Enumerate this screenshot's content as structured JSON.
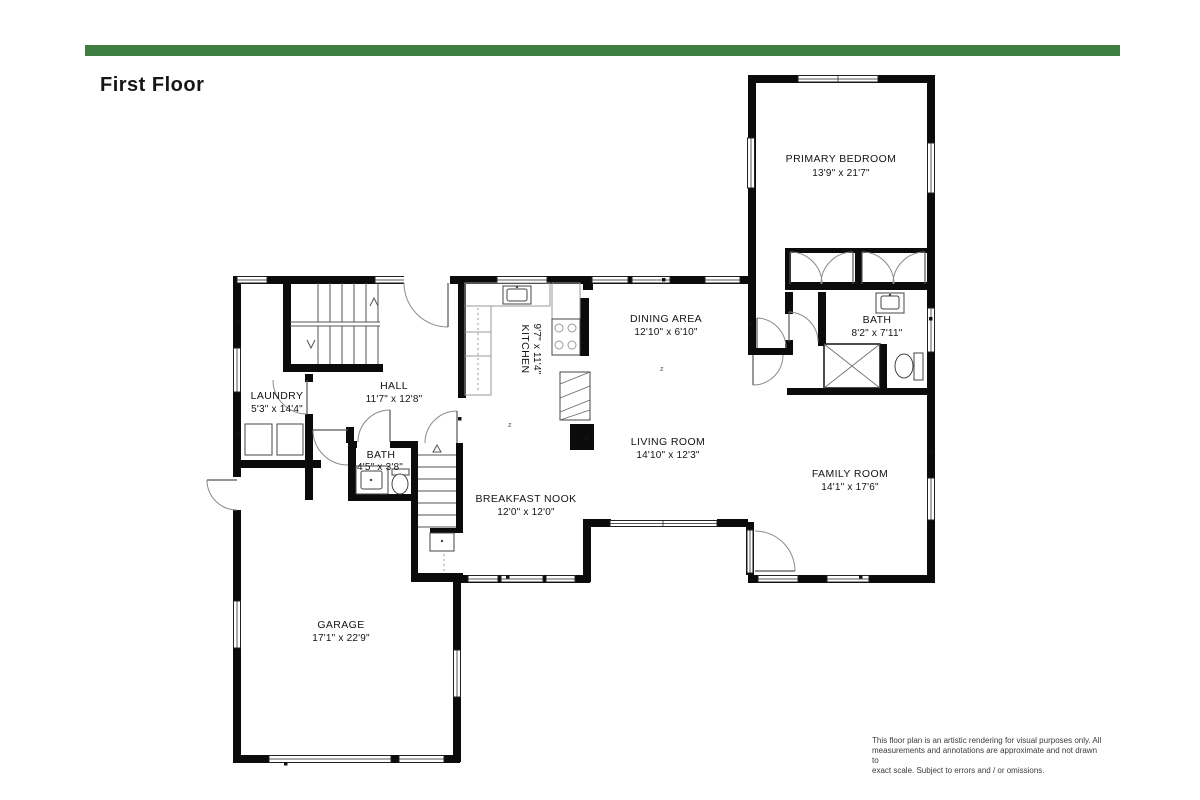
{
  "page": {
    "title": "First Floor",
    "accent_color": "#3E7E40",
    "background": "#ffffff"
  },
  "rooms": [
    {
      "name": "PRIMARY BEDROOM",
      "dims": "13'9\" x 21'7\""
    },
    {
      "name": "BATH",
      "dims": "8'2\" x 7'11\""
    },
    {
      "name": "DINING AREA",
      "dims": "12'10\" x 6'10\""
    },
    {
      "name": "KITCHEN",
      "dims": "9'7\" x 11'4\""
    },
    {
      "name": "HALL",
      "dims": "11'7\" x 12'8\""
    },
    {
      "name": "LAUNDRY",
      "dims": "5'3\" x 14'4\""
    },
    {
      "name": "BATH",
      "dims": "4'5\" x 3'8\""
    },
    {
      "name": "BREAKFAST NOOK",
      "dims": "12'0\" x 12'0\""
    },
    {
      "name": "LIVING ROOM",
      "dims": "14'10\" x 12'3\""
    },
    {
      "name": "FAMILY ROOM",
      "dims": "14'1\" x 17'6\""
    },
    {
      "name": "GARAGE",
      "dims": "17'1\" x 22'9\""
    }
  ],
  "disclaimer": {
    "line1": "This floor plan is an artistic rendering for visual purposes only.  All",
    "line2": "measurements and annotations are approximate and not drawn to",
    "line3": "exact scale. Subject to errors and / or omissions."
  }
}
